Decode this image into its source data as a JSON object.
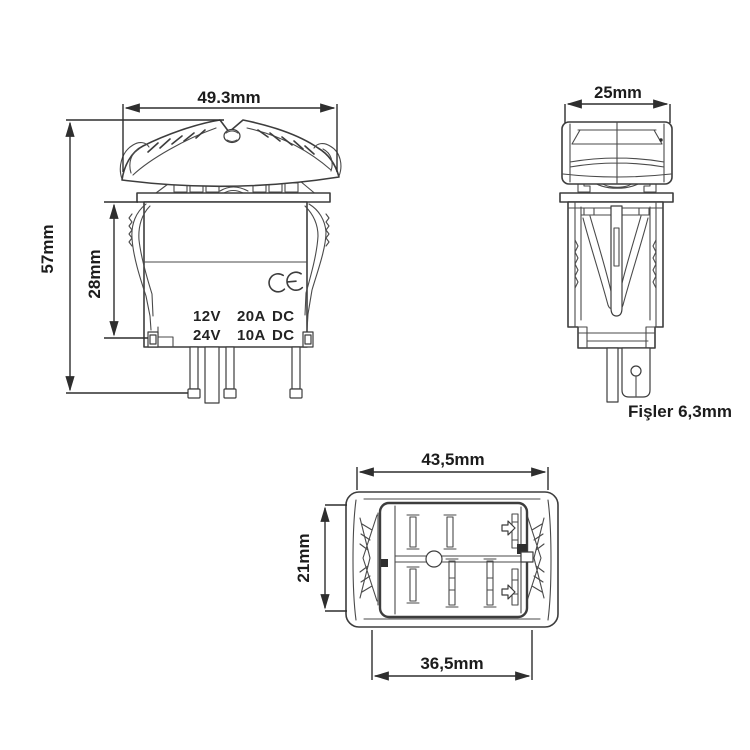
{
  "colors": {
    "background": "#ffffff",
    "line": "#3d3d3d",
    "dimension_line": "#2e2e2e",
    "text": "#1c1c1c"
  },
  "front_view": {
    "width_label": "49.3mm",
    "height_label": "57mm",
    "body_height_label": "28mm",
    "ce_mark": "CE",
    "ratings": [
      [
        "12V",
        "20A",
        "DC"
      ],
      [
        "24V",
        "10A",
        "DC"
      ]
    ]
  },
  "side_view": {
    "width_label": "25mm",
    "terminal_label": "Fişler 6,3mm"
  },
  "bottom_view": {
    "width_label": "43,5mm",
    "height_label": "21mm",
    "inner_width_label": "36,5mm"
  }
}
